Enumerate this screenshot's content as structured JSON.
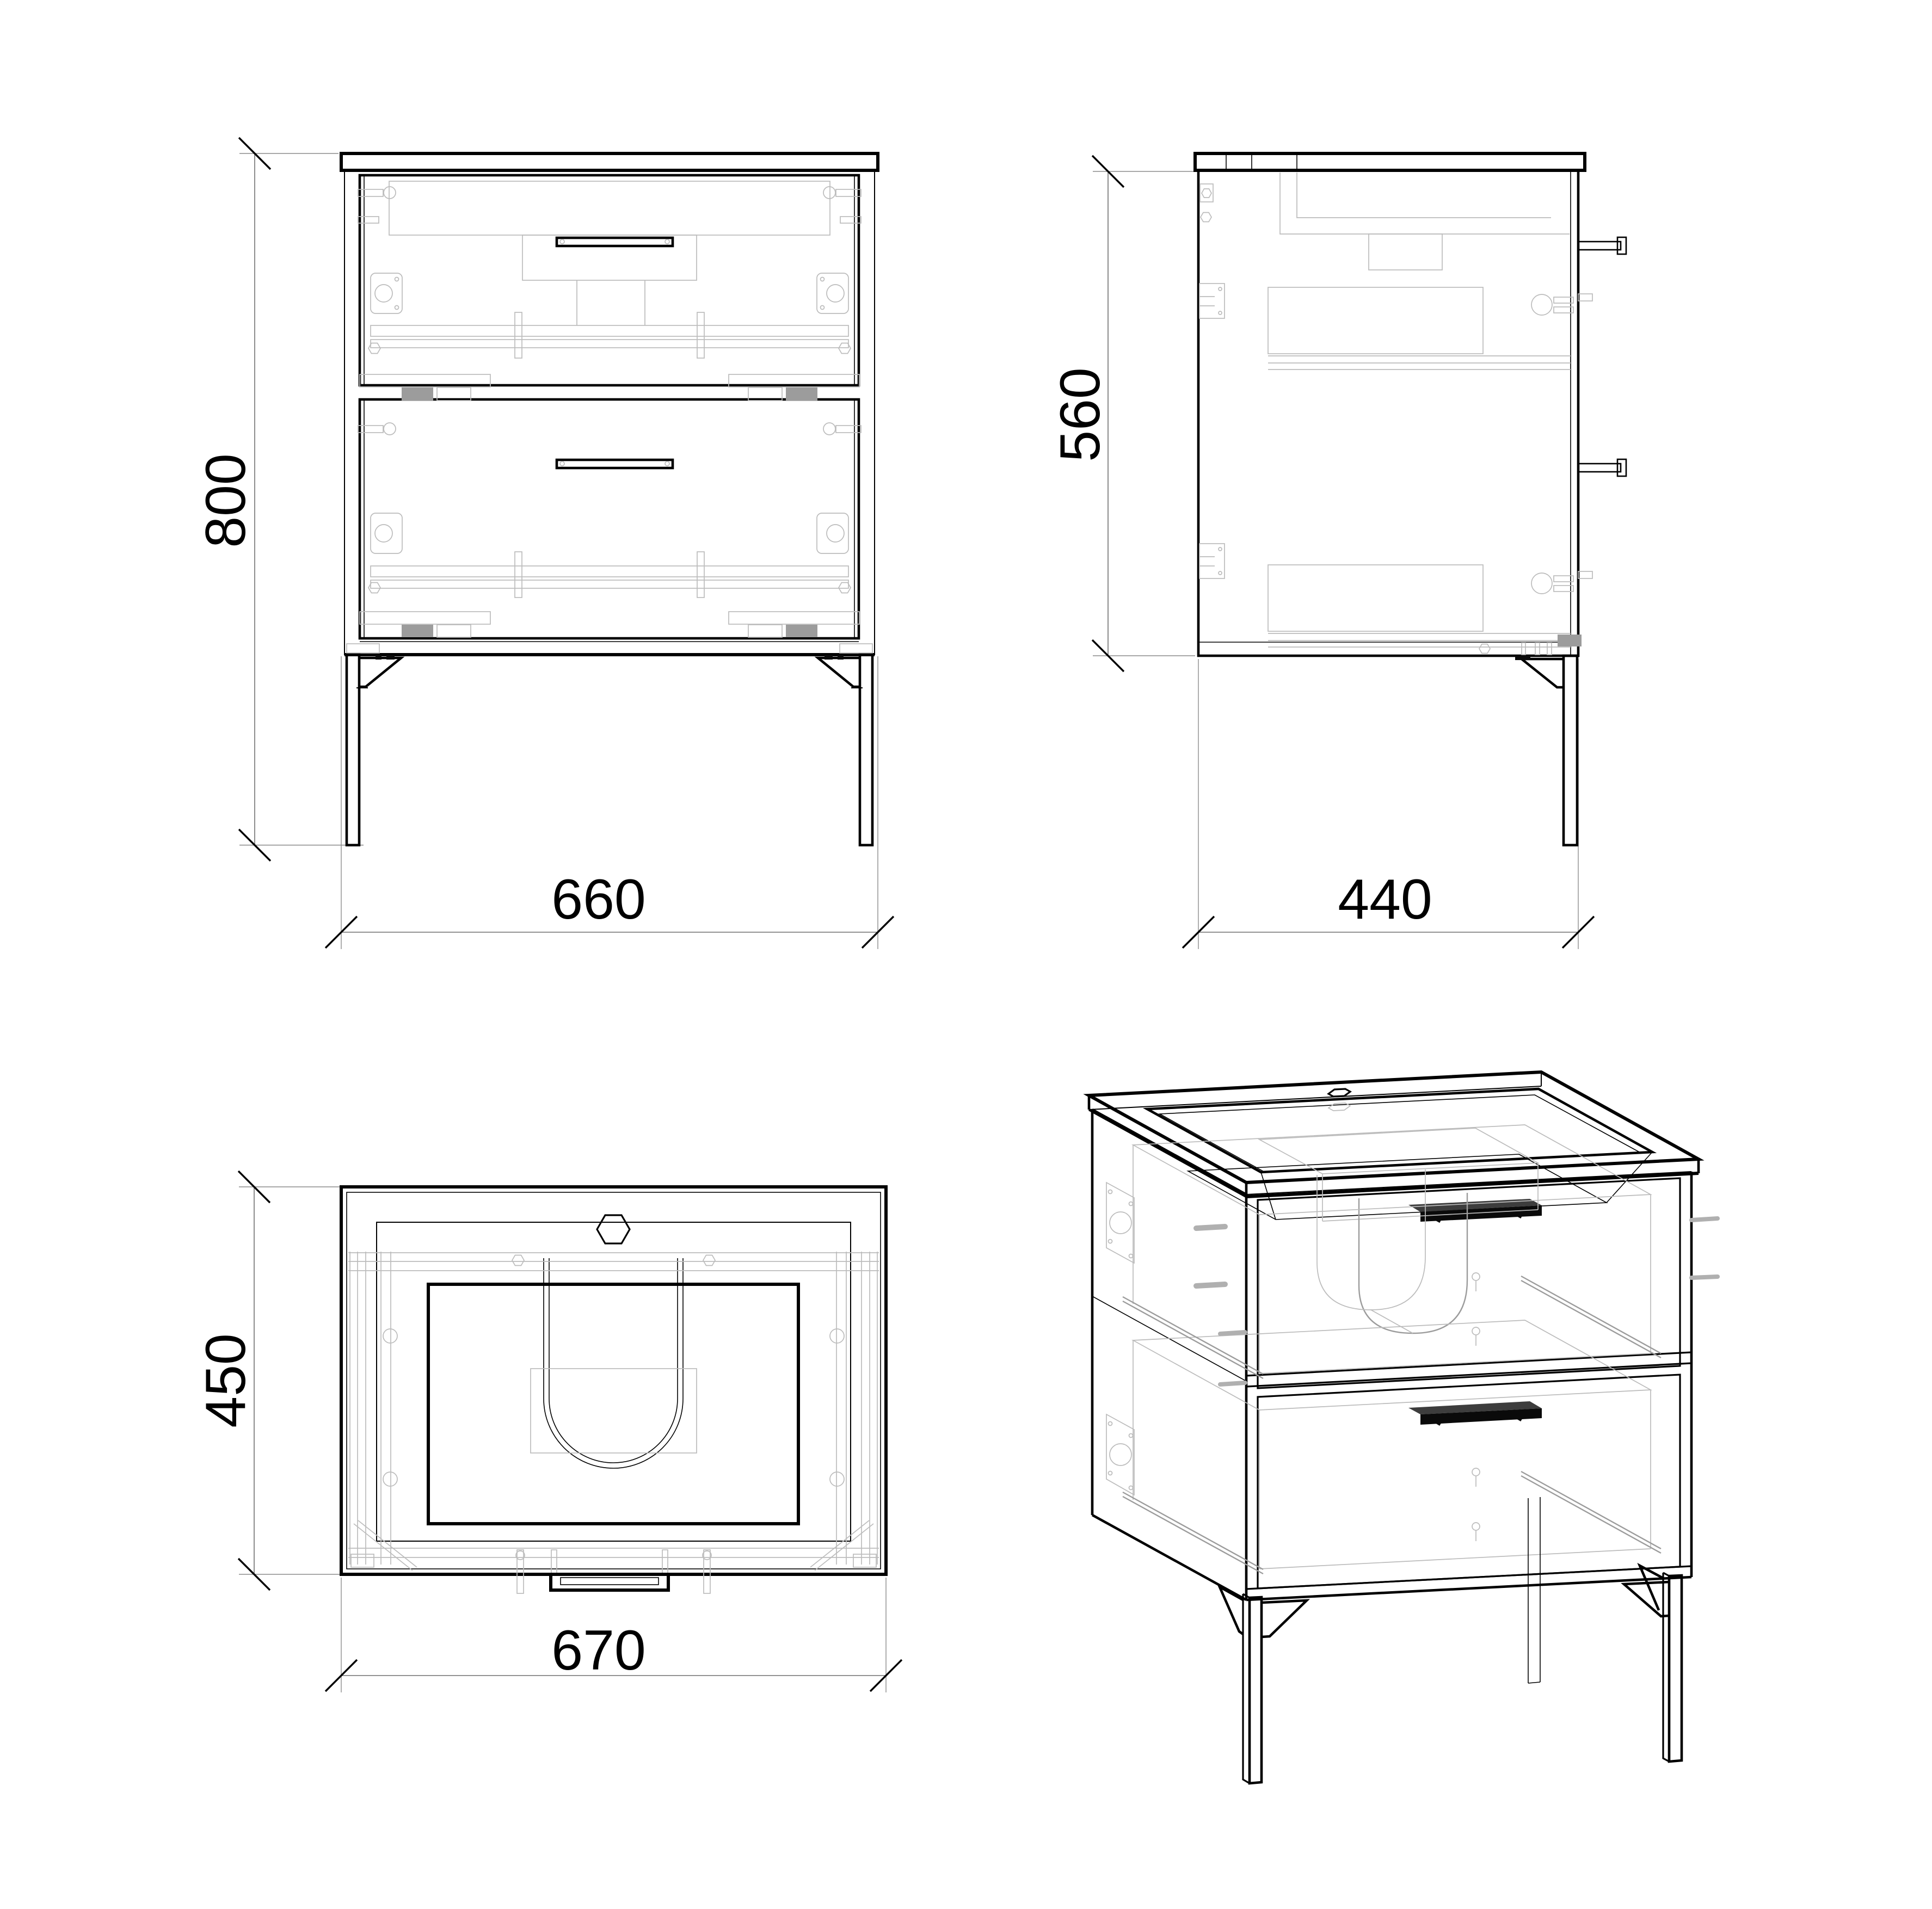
{
  "drawing": {
    "background": "#ffffff",
    "line_color": "#000000",
    "detail_color": "#bcbcbc"
  },
  "views": {
    "front": {
      "height_label": "800",
      "width_label": "660"
    },
    "side": {
      "height_label": "560",
      "width_label": "440"
    },
    "top": {
      "height_label": "450",
      "width_label": "670"
    }
  },
  "dimension_values": {
    "overall_height": 800,
    "front_width": 660,
    "side_depth": 440,
    "top_depth": 450,
    "top_width": 670,
    "carcass_height": 560
  }
}
